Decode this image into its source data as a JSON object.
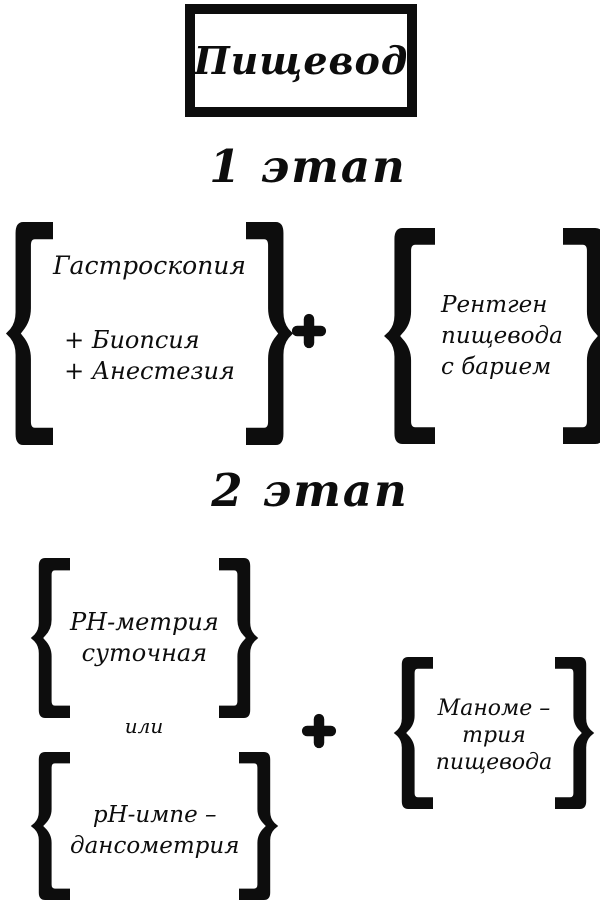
{
  "colors": {
    "ink": "#0d0d0d",
    "background": "#ffffff"
  },
  "title": {
    "text": "Пищевод"
  },
  "stage1": {
    "label": "1 этап",
    "gastroscopy": {
      "line1": "Гастроскопия",
      "line2": "+ Биопсия",
      "line3": "+ Анестезия"
    },
    "plus": "+",
    "xray": {
      "line1": "Рентген",
      "line2": "пищевода",
      "line3": "с барием"
    }
  },
  "stage2": {
    "label": "2 этап",
    "ph_metry": {
      "line1": "PH-метрия",
      "line2": "суточная"
    },
    "or_label": "или",
    "ph_impedance": {
      "line1": "pH-импе –",
      "line2": "дансометрия"
    },
    "plus": "+",
    "manometry": {
      "line1": "Маноме –",
      "line2": "трия",
      "line3": "пищевода"
    }
  }
}
